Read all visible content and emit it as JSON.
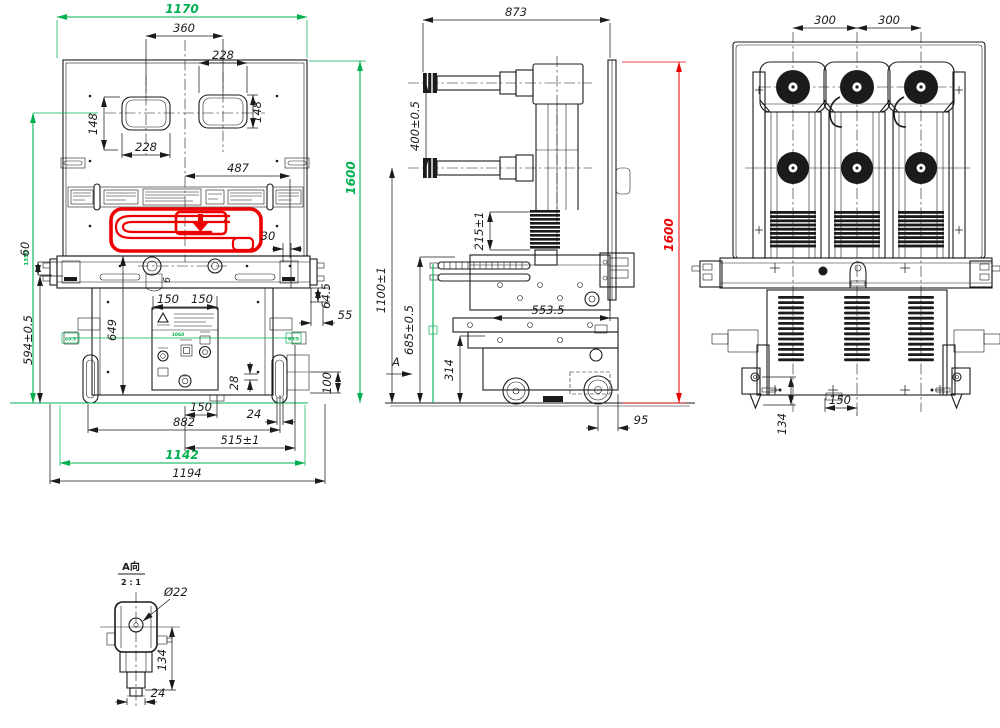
{
  "drawing_title": "Circuit breaker outline drawing (front / side / rear views with detail A)",
  "colors": {
    "line": "#1b1b1b",
    "highlight_green": "#00b050",
    "highlight_red": "#ee0000"
  },
  "front": {
    "w1170": "1170",
    "d360": "360",
    "d228r": "228",
    "d148r": "148",
    "d228l": "228",
    "d148l": "148",
    "d487": "487",
    "h1600": "1600",
    "d30": "30",
    "d60": "60",
    "d6": "6",
    "d594": "594±0.5",
    "d649": "649",
    "d150a": "150",
    "d150b": "150",
    "d64_5": "64.5",
    "d55": "55",
    "left_h": "1350",
    "wheel_l": "60.5",
    "wheel_r": "60.5",
    "mid_g": "1060",
    "d28": "28",
    "d100": "100",
    "d150c": "150",
    "d24": "24",
    "d882": "882",
    "d515": "515±1",
    "w1142": "1142",
    "w1194": "1194"
  },
  "side": {
    "d873": "873",
    "d400": "400±0.5",
    "d215": "215±1",
    "h1600": "1600",
    "d1100": "1100±1",
    "d685": "685±0.5",
    "d314": "314",
    "d553": "553.5",
    "d95": "95",
    "view_label": "A"
  },
  "rear": {
    "d300a": "300",
    "d300b": "300",
    "d150": "150",
    "d134": "134"
  },
  "detail": {
    "title": "A向",
    "scale": "2 : 1",
    "dia": "Ø22",
    "d134": "134",
    "d24": "24"
  }
}
